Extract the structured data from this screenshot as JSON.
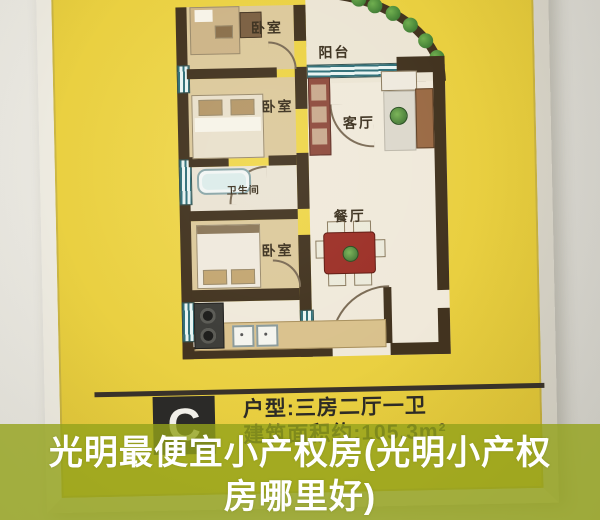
{
  "poster": {
    "floor_plan": {
      "rooms": {
        "bedroom_top": "卧室",
        "balcony": "阳台",
        "bedroom_middle": "卧室",
        "living_room": "客厅",
        "bathroom": "卫生间",
        "bedroom_bottom": "卧室",
        "dining_room": "餐厅"
      }
    },
    "info": {
      "unit_letter": "C",
      "layout_line": "户型:三房二厅一卫",
      "area_line": "建筑面积约:105.3m²"
    },
    "colors": {
      "poster_yellow": "#e9cf40",
      "plan_wall_dark": "#42331f",
      "info_text": "#2d2b26",
      "frame_white": "#f4f1e8"
    }
  },
  "banner": {
    "title_line1": "光明最便宜小产权房(光明小产权",
    "title_line2": "房哪里好)",
    "overlay_color": "#93a21a",
    "text_color": "#ffffff"
  }
}
